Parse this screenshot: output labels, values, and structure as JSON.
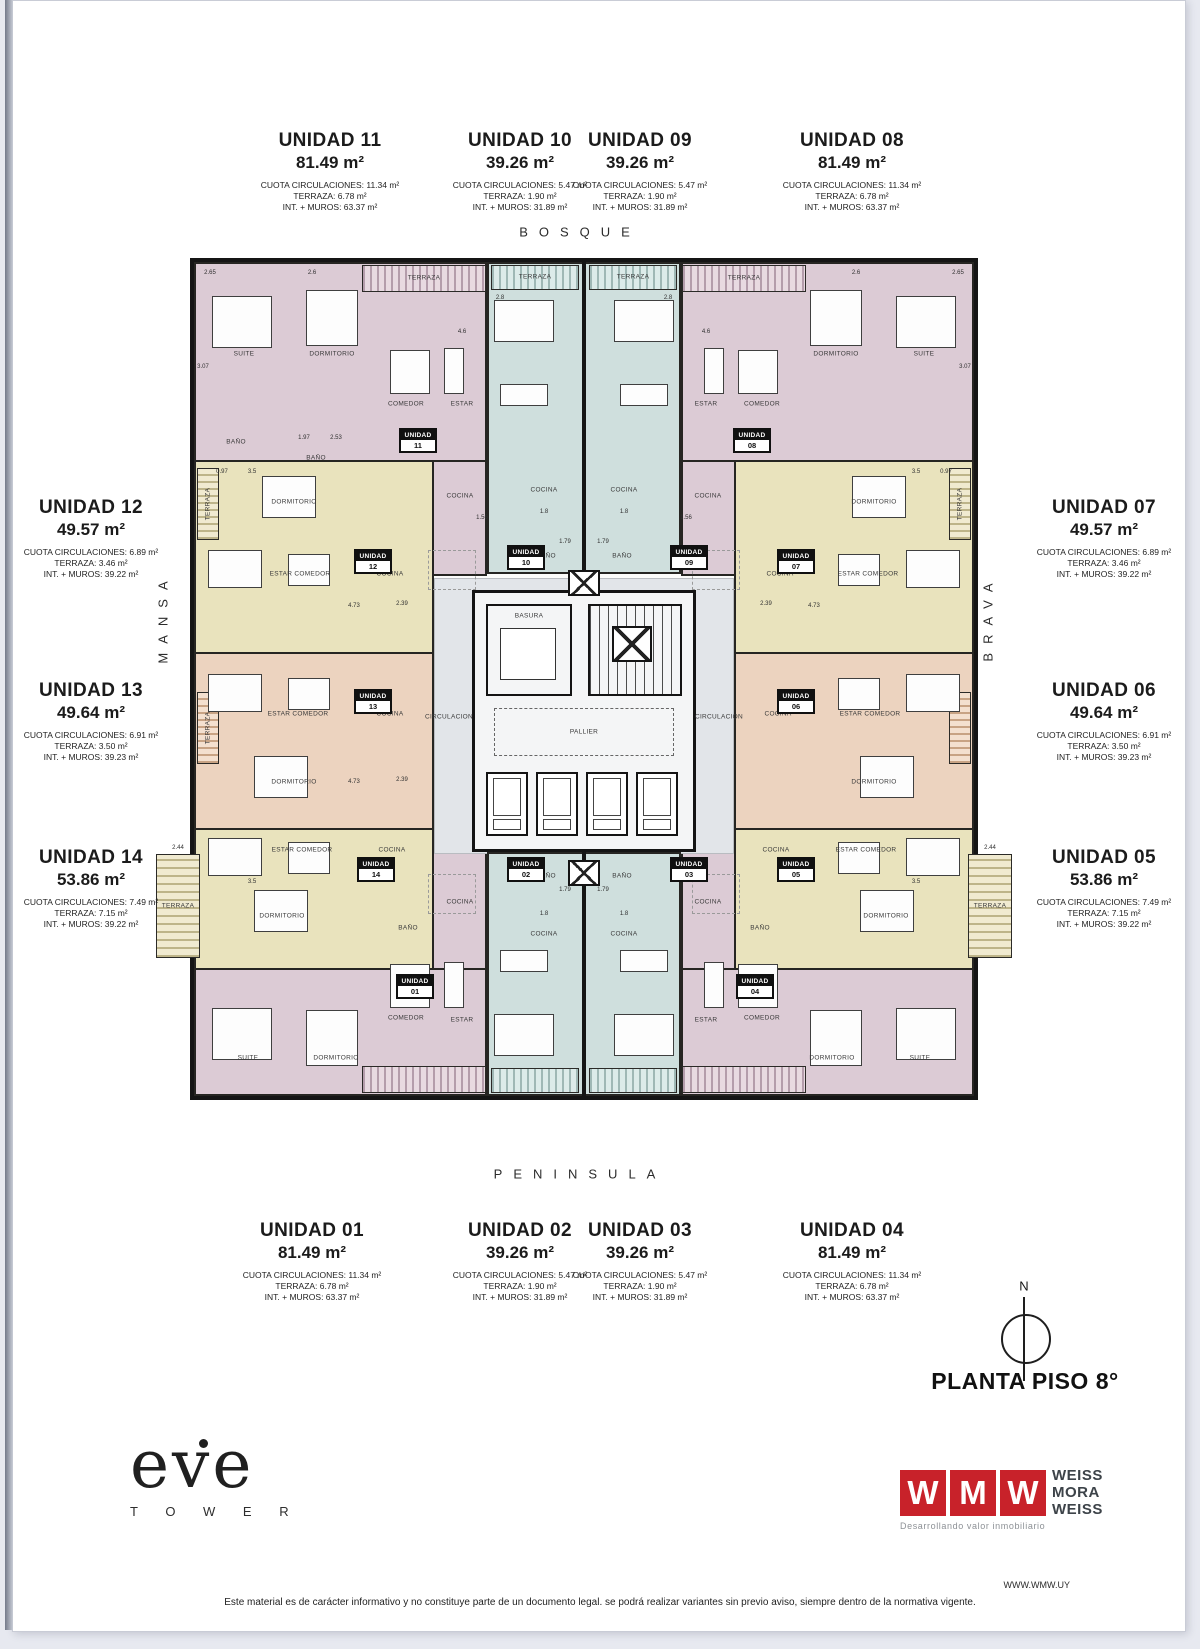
{
  "units": [
    {
      "name": "UNIDAD 01",
      "area": "81.49 m²",
      "cuota": "CUOTA CIRCULACIONES: 11.34 m²",
      "terraza": "TERRAZA: 6.78 m²",
      "int_muros": "INT. + MUROS: 63.37 m²"
    },
    {
      "name": "UNIDAD 02",
      "area": "39.26 m²",
      "cuota": "CUOTA CIRCULACIONES: 5.47 m²",
      "terraza": "TERRAZA: 1.90 m²",
      "int_muros": "INT. + MUROS: 31.89 m²"
    },
    {
      "name": "UNIDAD 03",
      "area": "39.26 m²",
      "cuota": "CUOTA CIRCULACIONES: 5.47 m²",
      "terraza": "TERRAZA: 1.90 m²",
      "int_muros": "INT. + MUROS: 31.89 m²"
    },
    {
      "name": "UNIDAD 04",
      "area": "81.49 m²",
      "cuota": "CUOTA CIRCULACIONES: 11.34 m²",
      "terraza": "TERRAZA: 6.78 m²",
      "int_muros": "INT. + MUROS: 63.37 m²"
    },
    {
      "name": "UNIDAD 05",
      "area": "53.86 m²",
      "cuota": "CUOTA CIRCULACIONES: 7.49 m²",
      "terraza": "TERRAZA: 7.15 m²",
      "int_muros": "INT. + MUROS: 39.22 m²"
    },
    {
      "name": "UNIDAD 06",
      "area": "49.64 m²",
      "cuota": "CUOTA CIRCULACIONES: 6.91 m²",
      "terraza": "TERRAZA: 3.50 m²",
      "int_muros": "INT. + MUROS: 39.23 m²"
    },
    {
      "name": "UNIDAD 07",
      "area": "49.57 m²",
      "cuota": "CUOTA CIRCULACIONES: 6.89 m²",
      "terraza": "TERRAZA: 3.46 m²",
      "int_muros": "INT. + MUROS: 39.22 m²"
    },
    {
      "name": "UNIDAD 08",
      "area": "81.49 m²",
      "cuota": "CUOTA CIRCULACIONES: 11.34 m²",
      "terraza": "TERRAZA: 6.78 m²",
      "int_muros": "INT. + MUROS: 63.37 m²"
    },
    {
      "name": "UNIDAD 09",
      "area": "39.26 m²",
      "cuota": "CUOTA CIRCULACIONES: 5.47 m²",
      "terraza": "TERRAZA: 1.90 m²",
      "int_muros": "INT. + MUROS: 31.89 m²"
    },
    {
      "name": "UNIDAD 10",
      "area": "39.26 m²",
      "cuota": "CUOTA CIRCULACIONES: 5.47 m²",
      "terraza": "TERRAZA: 1.90 m²",
      "int_muros": "INT. + MUROS: 31.89 m²"
    },
    {
      "name": "UNIDAD 11",
      "area": "81.49 m²",
      "cuota": "CUOTA CIRCULACIONES: 11.34 m²",
      "terraza": "TERRAZA: 6.78 m²",
      "int_muros": "INT. + MUROS: 63.37 m²"
    },
    {
      "name": "UNIDAD 12",
      "area": "49.57 m²",
      "cuota": "CUOTA CIRCULACIONES: 6.89 m²",
      "terraza": "TERRAZA: 3.46 m²",
      "int_muros": "INT. + MUROS: 39.22 m²"
    },
    {
      "name": "UNIDAD 13",
      "area": "49.64 m²",
      "cuota": "CUOTA CIRCULACIONES: 6.91 m²",
      "terraza": "TERRAZA: 3.50 m²",
      "int_muros": "INT. + MUROS: 39.23 m²"
    },
    {
      "name": "UNIDAD 14",
      "area": "53.86 m²",
      "cuota": "CUOTA CIRCULACIONES: 7.49 m²",
      "terraza": "TERRAZA: 7.15 m²",
      "int_muros": "INT. + MUROS: 39.22 m²"
    }
  ],
  "streets": {
    "top": "BOSQUE",
    "bottom": "PENINSULA",
    "left": "MANSA",
    "right": "BRAVA"
  },
  "plan": {
    "tag_word": "UNIDAD",
    "tags": {
      "t01": "01",
      "t02": "02",
      "t03": "03",
      "t04": "04",
      "t05": "05",
      "t06": "06",
      "t07": "07",
      "t08": "08",
      "t09": "09",
      "t10": "10",
      "t11": "11",
      "t12": "12",
      "t13": "13",
      "t14": "14"
    },
    "rooms": {
      "suite": "SUITE",
      "dormitorio": "DORMITORIO",
      "comedor": "COMEDOR",
      "estar": "ESTAR",
      "estar_comedor": "ESTAR COMEDOR",
      "cocina": "COCINA",
      "bano": "BAÑO",
      "terraza": "TERRAZA",
      "basura": "BASURA",
      "pallier": "PALLIER",
      "circulacion": "CIRCULACION"
    },
    "dims": {
      "v265": "2.65",
      "v26": "2.6",
      "v28": "2.8",
      "v46": "4.6",
      "v307": "3.07",
      "v197": "1.97",
      "v253": "2.53",
      "v35": "3.5",
      "v097": "0.97",
      "v473": "4.73",
      "v239": "2.39",
      "v156": "1.56",
      "v18": "1.8",
      "v179": "1.79",
      "v244": "2.44"
    }
  },
  "compass": {
    "n": "N"
  },
  "plan_title": "PLANTA PISO 8°",
  "logo_eve": {
    "name": "eve",
    "sub": "T O W E R"
  },
  "logo_wmw": {
    "l1": "W",
    "l2": "M",
    "l3": "W",
    "n1": "WEISS",
    "n2": "MORA",
    "n3": "WEISS",
    "tagline": "Desarrollando valor inmobiliario",
    "red": "#c8222a"
  },
  "website": "WWW.WMW.UY",
  "disclaimer": "Este material es de carácter informativo y no constituye parte de un documento legal. se podrá realizar variantes sin previo aviso, siempre dentro de la normativa vigente.",
  "colors": {
    "pink": "#dccbd5",
    "yellow": "#e9e3bd",
    "peach": "#ecd3bf",
    "teal": "#cfdfdd",
    "circulation_gray": "#e2e5e9"
  }
}
